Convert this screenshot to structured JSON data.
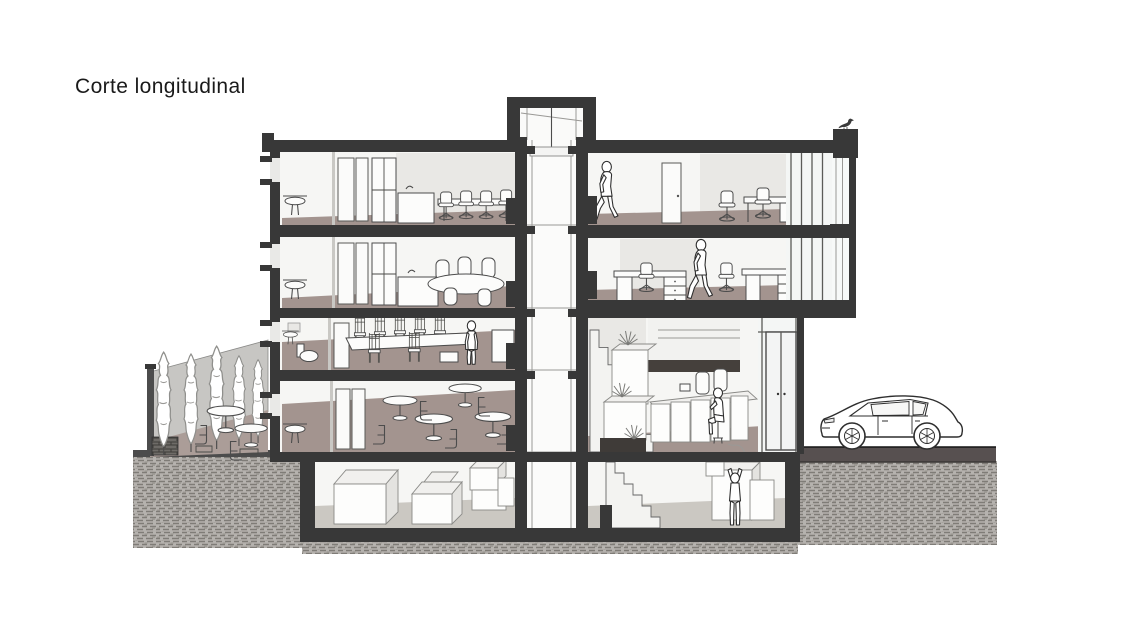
{
  "title": "Corte longitudinal",
  "colors": {
    "background": "#ffffff",
    "ink": "#1a1a1a",
    "structure": "#383838",
    "floor": "#a3948f",
    "terrace": "#ab9d98",
    "concrete": "#cbc8c2",
    "earth": "#b5b2ae",
    "earth-dash": "#7f7c77",
    "street": "#575050",
    "garden-wall": "#c7c6c3",
    "wall-back": "#f6f6f4",
    "wall-panel": "#e9e8e5",
    "glass": "#f4f6f5",
    "mezzanine": "#45403c",
    "outline": "#2e2e2e",
    "line": "#4c4c4c",
    "line-light": "#9a9996"
  },
  "scene": {
    "drawing_type": "building longitudinal section",
    "floors_above_ground": 4,
    "has_basement": true,
    "tree_count": 5,
    "person_count": 5,
    "vehicle_count": 1,
    "bird_count": 1
  }
}
